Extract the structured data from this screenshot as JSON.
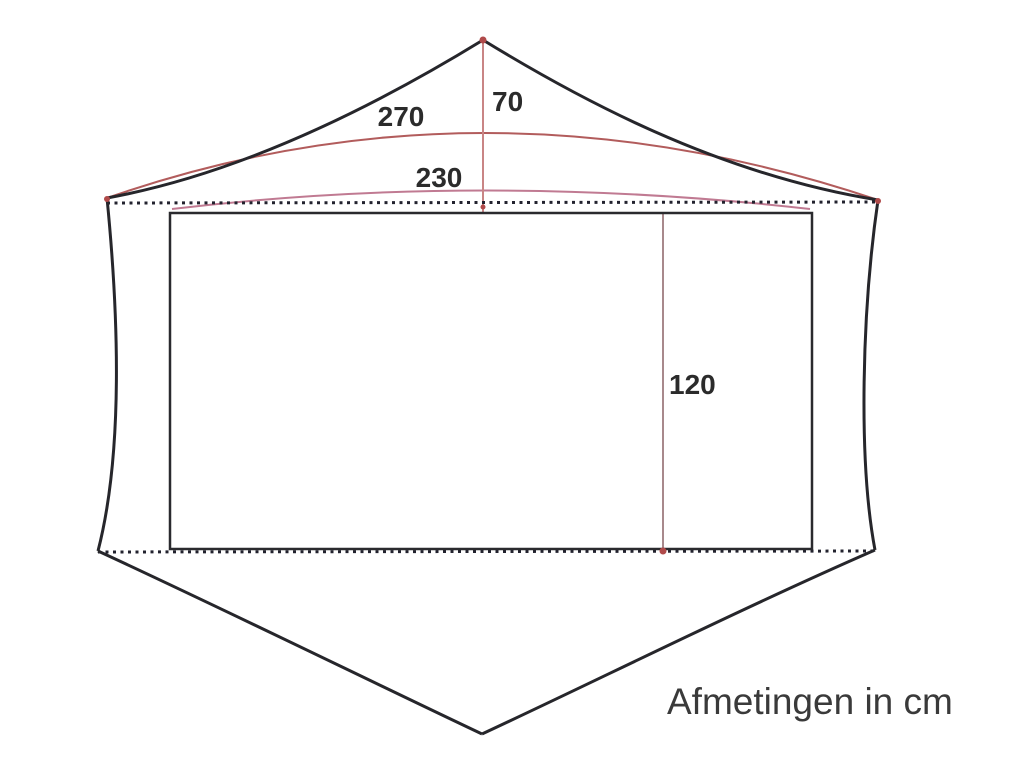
{
  "diagram": {
    "caption": "Afmetingen in cm",
    "labels": {
      "ridge_length": "270",
      "peak_height": "70",
      "inner_width": "230",
      "inner_height": "120"
    },
    "colors": {
      "outline": "#26262b",
      "inner_rect": "#2a2a2e",
      "dotted_line": "#22222e",
      "measure_red": "#b25c5c",
      "measure_light_red": "#c98585",
      "measure_pink": "#c07a92",
      "measure_gray_red": "#a8898c",
      "endpoint_dot": "#b04a4a",
      "label_text": "#2b2b2b",
      "caption_text": "#3a3a3a"
    }
  }
}
